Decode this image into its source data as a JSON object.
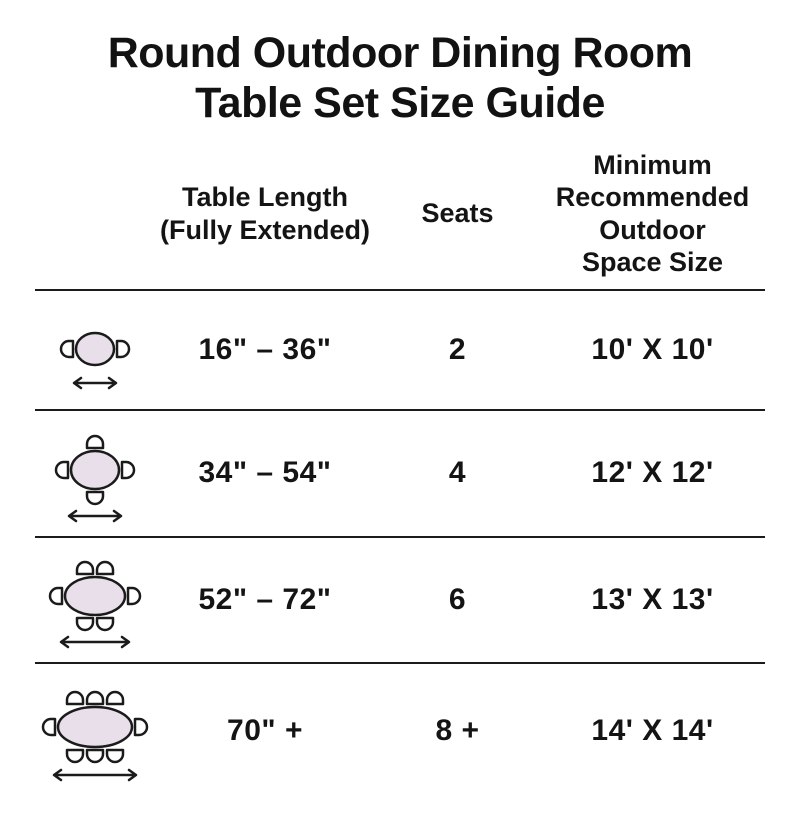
{
  "title": "Round Outdoor Dining Room\nTable Set Size Guide",
  "header": {
    "length": "Table Length\n(Fully Extended)",
    "seats": "Seats",
    "space": "Minimum\nRecommended\nOutdoor\nSpace Size"
  },
  "rows": [
    {
      "length": "16\" – 36\"",
      "seats": "2",
      "space": "10' X 10'",
      "icon": {
        "name": "table-2-seats-icon",
        "chairs": {
          "top": 0,
          "bottom": 0,
          "left": 1,
          "right": 1
        }
      }
    },
    {
      "length": "34\" – 54\"",
      "seats": "4",
      "space": "12' X 12'",
      "icon": {
        "name": "table-4-seats-icon",
        "chairs": {
          "top": 1,
          "bottom": 1,
          "left": 1,
          "right": 1
        }
      }
    },
    {
      "length": "52\" – 72\"",
      "seats": "6",
      "space": "13' X 13'",
      "icon": {
        "name": "table-6-seats-icon",
        "chairs": {
          "top": 2,
          "bottom": 2,
          "left": 1,
          "right": 1
        }
      }
    },
    {
      "length": "70\" +",
      "seats": "8 +",
      "space": "14' X 14'",
      "icon": {
        "name": "table-8-seats-icon",
        "chairs": {
          "top": 3,
          "bottom": 3,
          "left": 1,
          "right": 1
        }
      }
    }
  ],
  "colors": {
    "text": "#141414",
    "line": "#1b1b1b",
    "table_fill": "#e9dfeb",
    "chair_fill": "#ffffff",
    "stroke": "#1b1b1b"
  },
  "chart_data": {
    "type": "table",
    "title": "Round Outdoor Dining Room Table Set Size Guide",
    "columns": [
      "Table Length (Fully Extended)",
      "Seats",
      "Minimum Recommended Outdoor Space Size"
    ],
    "rows": [
      [
        "16\" – 36\"",
        "2",
        "10' X 10'"
      ],
      [
        "34\" – 54\"",
        "4",
        "12' X 12'"
      ],
      [
        "52\" – 72\"",
        "6",
        "13' X 13'"
      ],
      [
        "70\" +",
        "8 +",
        "14' X 14'"
      ]
    ]
  }
}
